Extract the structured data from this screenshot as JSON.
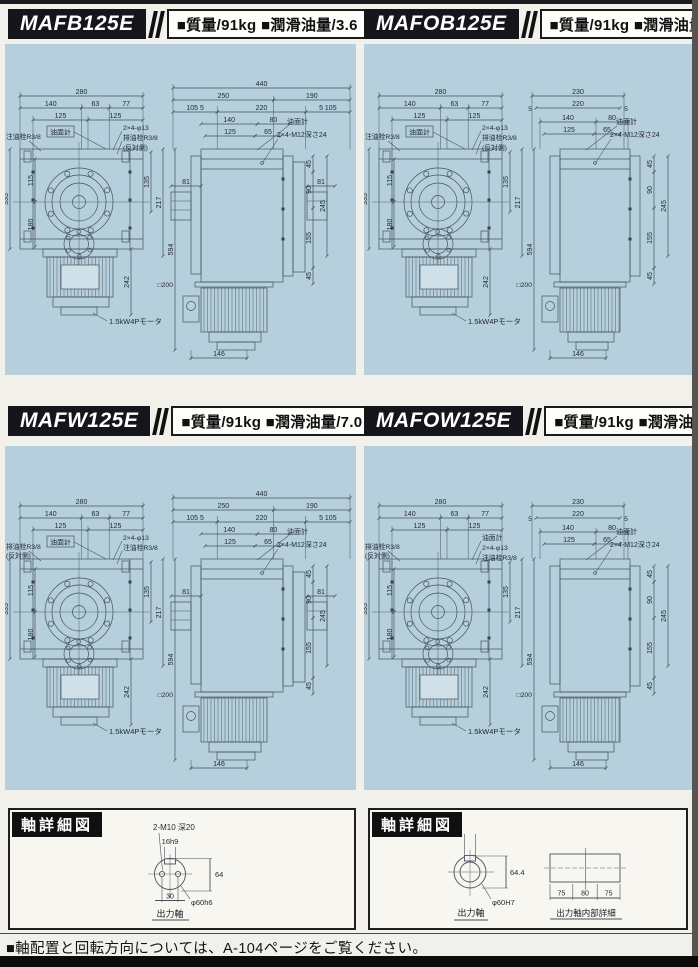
{
  "page": {
    "colors": {
      "panel_blue": "#b6cfdd",
      "header_black": "#15151b",
      "line": "#46525c"
    },
    "footer_note": "■軸配置と回転方向については、A-104ページをご覧ください。"
  },
  "quadrants": [
    {
      "model": "MAFB125E",
      "spec": "■質量/91kg ■潤滑油量/3.6",
      "front": {
        "w_total": "280",
        "w_chain": [
          "140",
          "63",
          "77"
        ],
        "w_chain2": [
          "125",
          "125"
        ],
        "left_v": [
          "335",
          "115",
          "180"
        ],
        "right_v": [
          "135",
          "217",
          "594"
        ],
        "plug_left": [
          "注油栓R3/8",
          ""
        ],
        "oil_gauge": "油面計",
        "right_labels": [
          "2×4-φ13",
          "排油栓R3/8",
          "(反対側)"
        ],
        "motor_h": "242",
        "motor_label": "1.5kW4Pモータ"
      },
      "side": {
        "w_total": "440",
        "chain1": [
          "250",
          "190"
        ],
        "chain2": [
          "105 5",
          "220",
          "5 105"
        ],
        "chain3": [
          "140",
          "80"
        ],
        "chain4": [
          "125",
          "65"
        ],
        "fives": [],
        "boss_l": "81",
        "boss_r": "81",
        "oil_gauge": "油面計",
        "tap_label": "2×4-M12深さ24",
        "right_v": [
          "45",
          "90",
          "245",
          "155",
          "45"
        ],
        "square": "□200",
        "motor_w": "146"
      }
    },
    {
      "model": "MAFOB125E",
      "spec": "■質量/91kg ■潤滑油量/3.8",
      "front": {
        "w_total": "280",
        "w_chain": [
          "140",
          "63",
          "77"
        ],
        "w_chain2": [
          "125",
          "125"
        ],
        "left_v": [
          "335",
          "115",
          "180"
        ],
        "right_v": [
          "135",
          "217",
          "594"
        ],
        "plug_left": [
          "注油栓R3/8",
          ""
        ],
        "oil_gauge": "油面計",
        "right_labels": [
          "2×4-φ13",
          "排油栓R3/8",
          "(反対側)"
        ],
        "motor_h": "242",
        "motor_label": "1.5kW4Pモータ"
      },
      "side": {
        "w_total": "230",
        "chain1": [
          "220"
        ],
        "fives": [
          "5",
          "5"
        ],
        "chain3": [
          "140",
          "80"
        ],
        "chain4": [
          "125",
          "65"
        ],
        "oil_gauge": "油面計",
        "tap_label": "2×4-M12深さ24",
        "right_v": [
          "45",
          "90",
          "245",
          "155",
          "45"
        ],
        "square": "□200",
        "motor_w": "146"
      }
    },
    {
      "model": "MAFW125E",
      "spec": "■質量/91kg ■潤滑油量/7.0",
      "front": {
        "w_total": "280",
        "w_chain": [
          "140",
          "63",
          "77"
        ],
        "w_chain2": [
          "125",
          "125"
        ],
        "left_v": [
          "335",
          "115",
          "180"
        ],
        "right_v": [
          "135",
          "217",
          "594"
        ],
        "plug_left": [
          "排油栓R3/8",
          "(反対側)"
        ],
        "oil_gauge": "油面計",
        "right_labels": [
          "2×4-φ13",
          "注油栓R3/8",
          ""
        ],
        "motor_h": "242",
        "motor_label": "1.5kW4Pモータ"
      },
      "side": {
        "w_total": "440",
        "chain1": [
          "250",
          "190"
        ],
        "chain2": [
          "105 5",
          "220",
          "5 105"
        ],
        "chain3": [
          "140",
          "80"
        ],
        "chain4": [
          "125",
          "65"
        ],
        "fives": [],
        "boss_l": "81",
        "boss_r": "81",
        "oil_gauge": "油面計",
        "tap_label": "2×4-M12深さ24",
        "right_v": [
          "45",
          "90",
          "245",
          "155",
          "45"
        ],
        "square": "□200",
        "motor_w": "146"
      }
    },
    {
      "model": "MAFOW125E",
      "spec": "■質量/91kg ■潤滑油量/7.2",
      "front": {
        "w_total": "280",
        "w_chain": [
          "140",
          "63",
          "77"
        ],
        "w_chain2": [
          "125",
          "125"
        ],
        "left_v": [
          "335",
          "115",
          "180"
        ],
        "right_v": [
          "135",
          "217",
          "594"
        ],
        "plug_left": [
          "排油栓R3/8",
          "(反対側)"
        ],
        "oil_gauge": "",
        "right_labels": [
          "油面計",
          "2×4-φ13",
          "注油栓R3/8"
        ],
        "motor_h": "242",
        "motor_label": "1.5kW4Pモータ"
      },
      "side": {
        "w_total": "230",
        "chain1": [
          "220"
        ],
        "fives": [
          "5",
          "5"
        ],
        "chain3": [
          "140",
          "80"
        ],
        "chain4": [
          "125",
          "65"
        ],
        "oil_gauge": "油面計",
        "tap_label": "2×4-M12深さ24",
        "right_v": [
          "45",
          "90",
          "245",
          "155",
          "45"
        ],
        "square": "□200",
        "motor_w": "146"
      }
    }
  ],
  "shaft": {
    "title": "軸詳細図",
    "left": {
      "tap": "2-M10 深20",
      "key": "16h9",
      "height": "64",
      "hole_span": "30",
      "dia": "φ60h6",
      "caption": "出力軸"
    },
    "right": {
      "key": "18Js9",
      "height": "64.4",
      "dia": "φ60H7",
      "caption": "出力軸",
      "chain": [
        "75",
        "80",
        "75"
      ],
      "caption2": "出力軸内部詳細"
    }
  }
}
